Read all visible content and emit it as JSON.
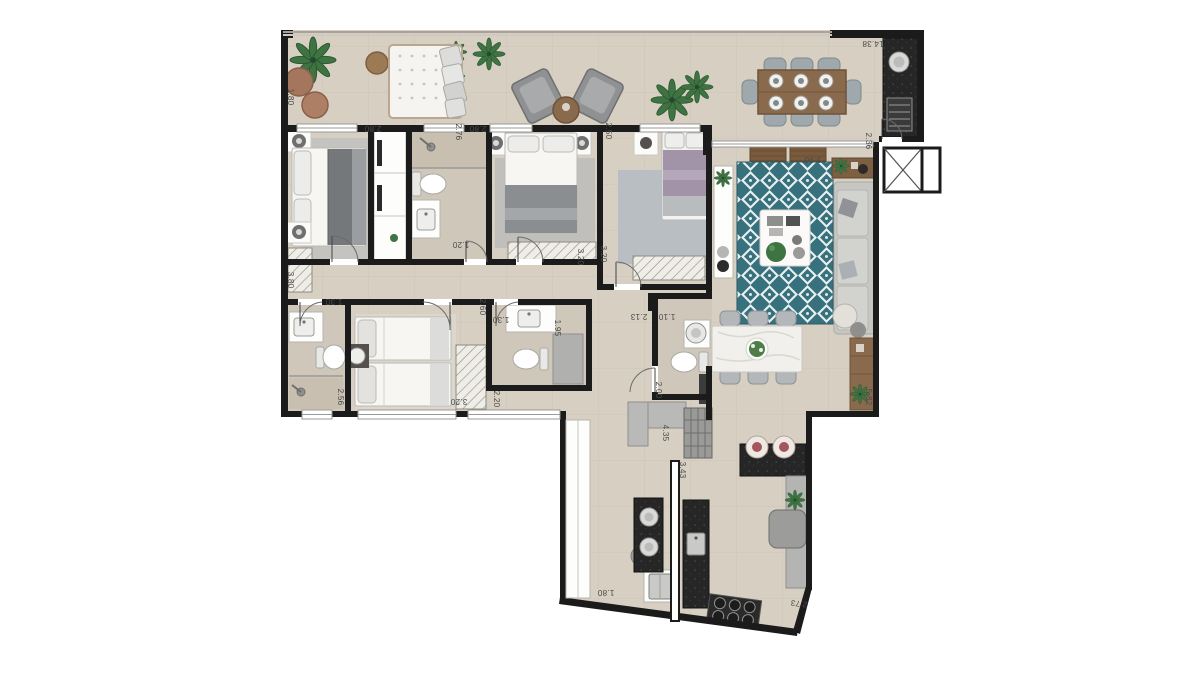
{
  "plan": {
    "type": "apartment-floor-plan",
    "palette": {
      "floor": "#d7cfc2",
      "wall": "#1b1b1b",
      "rug_accent_teal": "#38717e",
      "wood": "#7d5f41",
      "granite": "#262626",
      "bed_purple": "#a293a8",
      "plant_green": "#3e7342"
    },
    "furniture_icons": [
      "palm-plant-icon",
      "pouf-icon",
      "tufted-sofa-icon",
      "armchair-icon",
      "outdoor-dining-table-icon",
      "bbq-counter-icon",
      "grill-icon",
      "double-bed-icon",
      "single-bed-icon",
      "wardrobe-icon",
      "toilet-icon",
      "sink-icon",
      "shower-icon",
      "teal-rug-icon",
      "coffee-table-icon",
      "sofa-icon",
      "console-icon",
      "sideboard-icon",
      "dining-table-icon",
      "kitchen-island-icon",
      "stove-icon",
      "fridge-icon",
      "washer-icon",
      "breakfast-stool-icon",
      "elevator-icon"
    ],
    "dims": {
      "terrace_left": "1.80",
      "terrace_top": "14.38",
      "bed1_width": "2.80",
      "bath1_depth": "2.76",
      "bed2_width": "2.80",
      "bed3_top": "2.50",
      "living_width": "3.90",
      "hall_elevator": "2.36",
      "bath1_width": "1.20",
      "bed2_depth": "3.20",
      "bed3_depth": "3.20",
      "bed1_depth": "3.80",
      "bath2_width": "1.30",
      "twin_top": "2.60",
      "bath3_entry": "1.30",
      "bath3_shower": "1.95",
      "twin_left": "2.56",
      "twin_width": "3.20",
      "hall_width": "2.20",
      "corridor_a": "2.13",
      "corridor_b": "1.10",
      "powder_depth": "2.00",
      "service_a": "4.35",
      "service_b": "3.43",
      "kitchen_left": "1.80",
      "kitchen_diag": "2.73",
      "living_depth": "5.82"
    }
  }
}
